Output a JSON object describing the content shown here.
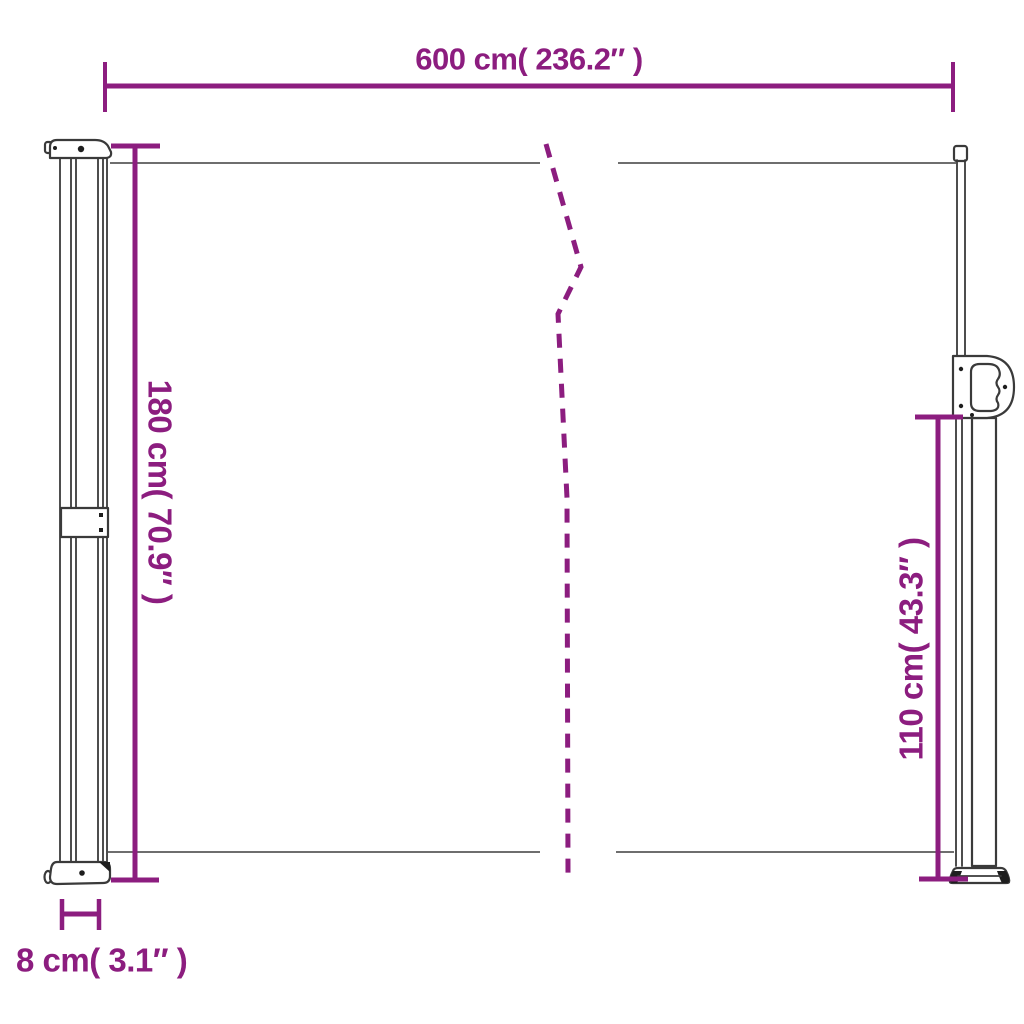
{
  "colors": {
    "accent": "#8C1D7F",
    "structure": "#3A3A3A",
    "fabric_line": "#5A5A5A",
    "background": "#FFFFFF"
  },
  "dimensions": {
    "width": {
      "label": "600 cm( 236.2″ )",
      "cm": 600,
      "inches": 236.2
    },
    "height_left": {
      "label": "180 cm( 70.9″ )",
      "cm": 180,
      "inches": 70.9
    },
    "height_right": {
      "label": "110 cm( 43.3″ )",
      "cm": 110,
      "inches": 43.3
    },
    "depth": {
      "label": "8 cm( 3.1″ )",
      "cm": 8,
      "inches": 3.1
    }
  }
}
